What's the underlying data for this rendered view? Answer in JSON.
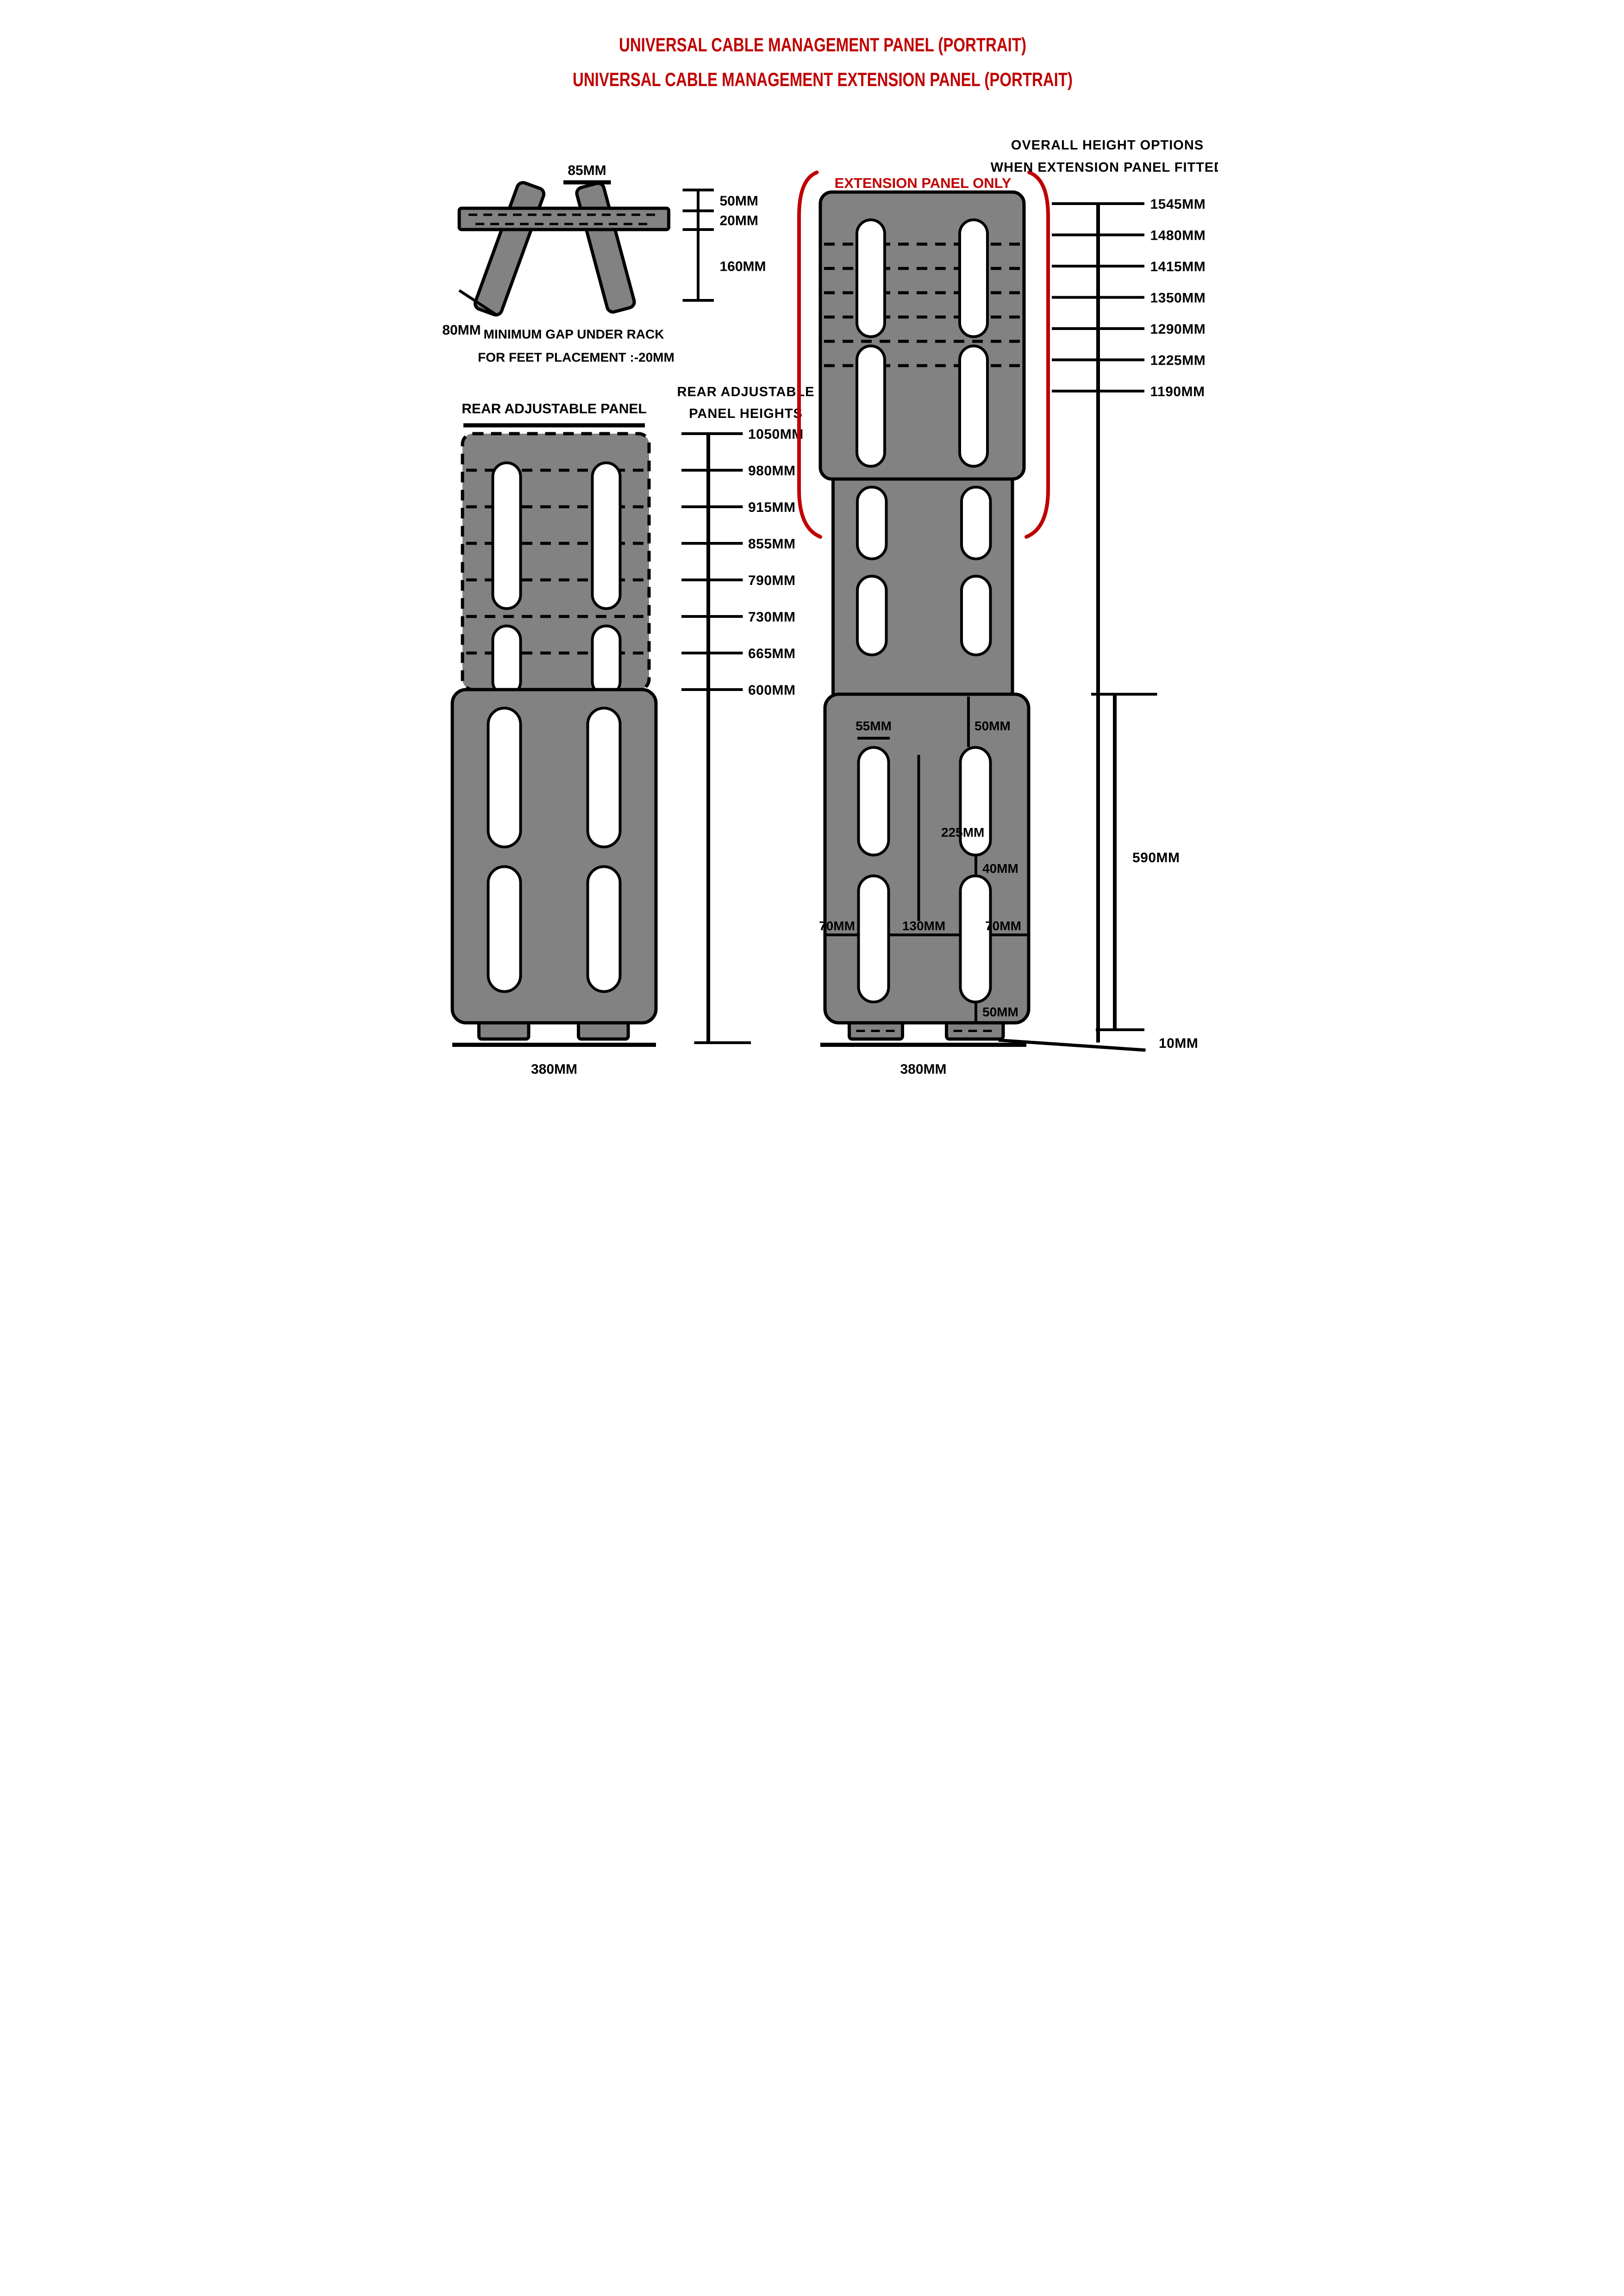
{
  "doc": {
    "title_line1": "UNIVERSAL CABLE MANAGEMENT PANEL (PORTRAIT)",
    "title_line2": "UNIVERSAL CABLE MANAGEMENT EXTENSION PANEL (PORTRAIT)"
  },
  "colors": {
    "red": "#C00000",
    "gray": "#828282",
    "black": "#000000"
  },
  "feet_detail": {
    "gap_width": "85MM",
    "above_rack": "50MM",
    "rack_thickness": "20MM",
    "below_rack": "160MM",
    "foot_width": "80MM",
    "note1": "MINIMUM GAP UNDER RACK",
    "note2": "FOR FEET PLACEMENT :-20MM"
  },
  "left_panel": {
    "title": "REAR ADJUSTABLE PANEL",
    "top_width": "310MM",
    "bottom_width": "380MM"
  },
  "height_ruler": {
    "title1": "REAR ADJUSTABLE",
    "title2": "PANEL HEIGHTS",
    "values": [
      "1050MM",
      "980MM",
      "915MM",
      "855MM",
      "790MM",
      "730MM",
      "665MM",
      "600MM"
    ]
  },
  "overall_ruler": {
    "title1": "OVERALL HEIGHT OPTIONS",
    "title2": "WHEN EXTENSION PANEL FITTED",
    "values": [
      "1545MM",
      "1480MM",
      "1415MM",
      "1350MM",
      "1290MM",
      "1225MM",
      "1190MM"
    ]
  },
  "right_panel": {
    "extension_label": "EXTENSION PANEL ONLY",
    "slot_width": "55MM",
    "slot_top_offset": "50MM",
    "slot_length": "225MM",
    "slot_gap": "40MM",
    "left_margin": "70MM",
    "center_spacing": "130MM",
    "right_margin": "70MM",
    "foot_inset": "50MM",
    "front_height": "590MM",
    "foot_clearance": "10MM",
    "bottom_width": "380MM"
  }
}
